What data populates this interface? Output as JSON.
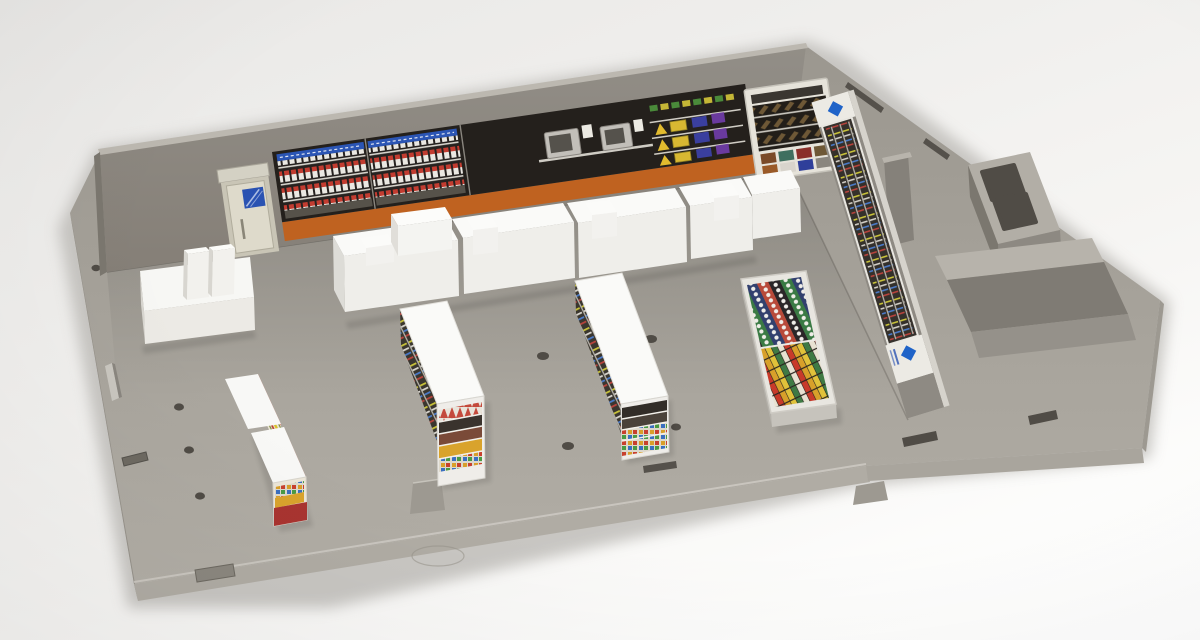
{
  "scene": {
    "subject": "plastic model kit of a convenience store interior",
    "style": "product photograph, angled top view",
    "visible_text": ""
  },
  "palette": {
    "backdrop": "#f0efed",
    "plastic_base": "#a6a29a",
    "plastic_wall": "#8f8b84",
    "plastic_light": "#b6b2aa",
    "plastic_dark": "#7b776f",
    "decal_black": "#24201c",
    "decal_orange": "#bf6220",
    "counter_white": "#f4f3f0",
    "door_cream": "#dedacb",
    "window_blue": "#2a52b2",
    "brand_logo_blue": "#1f63c8",
    "shelf_red_base": "#a93430",
    "hole_dark": "#504c46"
  },
  "items": [
    {
      "name": "back-wall-cigarette-racks",
      "count_panels": 2
    },
    {
      "name": "microwave-station",
      "count": 2
    },
    {
      "name": "hot-food-warmer-decal"
    },
    {
      "name": "fried-snack-case"
    },
    {
      "name": "entry-door",
      "window_color": "#2a52b2"
    },
    {
      "name": "magazine-rack-right-wall"
    },
    {
      "name": "brand-logo-diamond",
      "color": "#1f63c8",
      "count": 2
    },
    {
      "name": "checkout-counter",
      "segments": 4,
      "registers": 4
    },
    {
      "name": "office-machine-with-two-terminals"
    },
    {
      "name": "snack-gondola-red-base"
    },
    {
      "name": "gondola-shelf-center",
      "count": 2
    },
    {
      "name": "chilled-flat-case-printed-top"
    },
    {
      "name": "backroom-utility-bins",
      "openings": 2
    },
    {
      "name": "backroom-partition-walls"
    },
    {
      "name": "floor-mounting-holes",
      "count": 8
    }
  ]
}
